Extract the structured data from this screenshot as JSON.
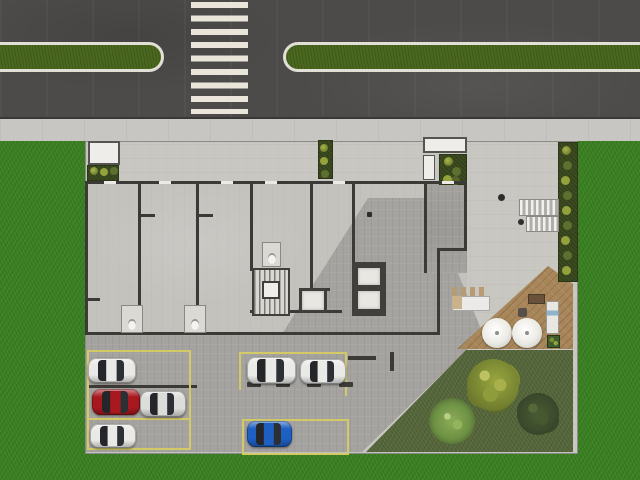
{
  "scene": {
    "kind": "architectural-site-plan-top-view",
    "road": {
      "crosswalk_stripe_count": 9,
      "median_strip_count": 2,
      "asphalt_color": "#4d4b49",
      "crosswalk_stripe_color": "#e9e5da",
      "median_green_color": "#4a681e",
      "median_border_color": "#e2dfd6"
    },
    "sidewalk": {
      "color": "#c7c6c3"
    },
    "grounds": {
      "grass_color": "#3a8122",
      "garden_color": "#57683c",
      "deck_color": "#a8865a",
      "hedge_bush_count": 9,
      "umbrella_count": 2,
      "trees": [
        {
          "id": "tree-olive",
          "shade": "olive-green"
        },
        {
          "id": "tree-light",
          "shade": "light-green"
        },
        {
          "id": "tree-dark",
          "shade": "dark-green"
        }
      ]
    },
    "building": {
      "floor_color": "#c4c2bd",
      "wall_color": "#3b3a37",
      "unit_partitions": 5,
      "stair_cores": 2,
      "elevator_cabins": 3,
      "bathroom_fixtures": 3,
      "planters": 3,
      "balconies": 2
    },
    "parking": {
      "line_color": "#d3ca67",
      "stall_groups": 3,
      "wheel_stop_count": 4,
      "vehicles": [
        {
          "id": "car-1",
          "color_name": "white",
          "hex": "#e9e9e7",
          "x": 88,
          "y": 358,
          "w": 48,
          "h": 25
        },
        {
          "id": "car-2",
          "color_name": "red",
          "hex": "#a8191f",
          "x": 92,
          "y": 389,
          "w": 48,
          "h": 26
        },
        {
          "id": "car-3",
          "color_name": "silver",
          "hex": "#dcdcda",
          "x": 140,
          "y": 391,
          "w": 46,
          "h": 26
        },
        {
          "id": "car-4",
          "color_name": "white",
          "hex": "#e9e9e7",
          "x": 90,
          "y": 424,
          "w": 46,
          "h": 24
        },
        {
          "id": "car-5",
          "color_name": "white",
          "hex": "#e9e9e7",
          "x": 247,
          "y": 357,
          "w": 49,
          "h": 27
        },
        {
          "id": "car-6",
          "color_name": "white",
          "hex": "#e9e9e7",
          "x": 300,
          "y": 359,
          "w": 46,
          "h": 25
        },
        {
          "id": "car-7",
          "color_name": "blue",
          "hex": "#1e5fc2",
          "x": 247,
          "y": 421,
          "w": 45,
          "h": 26
        }
      ]
    },
    "amenities": {
      "bar_counter": true,
      "sun_lounger": true,
      "plaza_stair_flights": 2
    }
  }
}
